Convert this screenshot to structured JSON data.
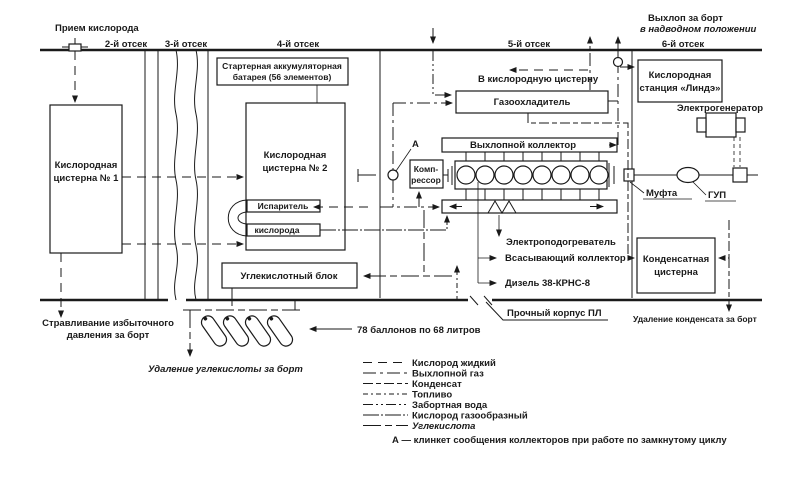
{
  "labels": {
    "priem": "Прием кислорода",
    "c2": "2-й отсек",
    "c3": "3-й отсек",
    "c4": "4-й отсек",
    "c5": "5-й отсек",
    "c6": "6-й отсек",
    "vyhlop1": "Выхлоп за борт",
    "vyhlop2": "в надводном положении",
    "v_kisl_cisternu": "В кислородную цистерну",
    "battery1": "Стартерная аккумуляторная",
    "battery2": "батарея (56 элементов)",
    "tank1_1": "Кислородная",
    "tank1_2": "цистерна № 1",
    "tank2_1": "Кислородная",
    "tank2_2": "цистерна № 2",
    "evap1": "Испаритель",
    "evap2": "кислорода",
    "co2block": "Углекислотный блок",
    "cooler": "Газоохладитель",
    "exh_manifold": "Выхлопной коллектор",
    "compressor1": "Комп-",
    "compressor2": "рессор",
    "valve_a": "А",
    "linde1": "Кислородная",
    "linde2": "станция «Линдэ»",
    "generator": "Электрогенератор",
    "gup": "ГУП",
    "mufta": "Муфта",
    "heater": "Электроподогреватель",
    "intake": "Всасывающий коллектор",
    "diesel": "Дизель 38-КРНС-8",
    "hull": "Прочный корпус ПЛ",
    "condensate1": "Конденсатная",
    "condensate2": "цистерна",
    "cond_removal": "Удаление конденсата за борт",
    "vent1": "Стравливание избыточного",
    "vent2": "давления за борт",
    "co2_removal": "Удаление углекислоты за борт",
    "balloons": "78 баллонов по 68 литров"
  },
  "legend": {
    "items": [
      {
        "label": "Кислород жидкий",
        "dash": "9,6"
      },
      {
        "label": "Выхлопной газ",
        "dash": "13,4,3,4"
      },
      {
        "label": "Конденсат",
        "dash": "10,3,5,3"
      },
      {
        "label": "Топливо",
        "dash": "5,3,2,3"
      },
      {
        "label": "Забортная вода",
        "dash": "10,3,2,3,2,3"
      },
      {
        "label": "Кислород газообразный",
        "dash": "16,2,2,2"
      },
      {
        "label": "Углекислота",
        "dash": "18,4,7,4"
      }
    ],
    "note": "А — клинкет сообщения коллекторов при работе по замкнутому циклу"
  },
  "colors": {
    "ink": "#1a1a1a",
    "paper": "#ffffff"
  }
}
